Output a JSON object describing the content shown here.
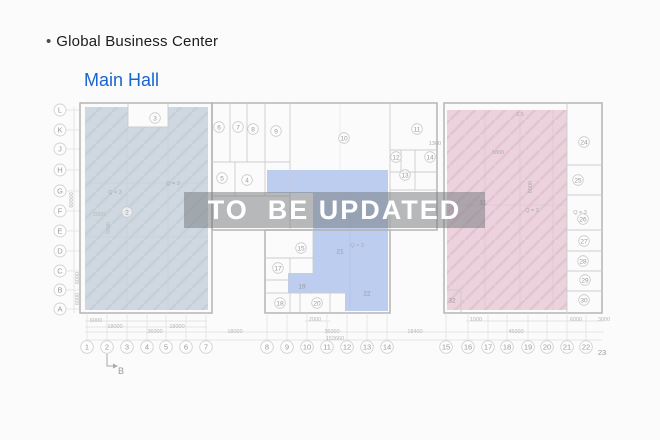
{
  "header": {
    "bullet": "•",
    "title": "Global Business Center",
    "subtitle": "Main Hall"
  },
  "overlay": {
    "text": "TO  BE UPDATED"
  },
  "colors": {
    "accent_blue": "#1a63d2",
    "zone_left": "#cfd8e1",
    "zone_center": "#b6c9ef",
    "zone_right": "#ebd2dc",
    "watermark_text": "#ffffff"
  },
  "plan": {
    "row_labels": [
      "L",
      "K",
      "J",
      "H",
      "G",
      "F",
      "E",
      "D",
      "C",
      "B",
      "A"
    ],
    "col_labels": [
      "1",
      "2",
      "3",
      "4",
      "5",
      "6",
      "7",
      "8",
      "9",
      "10",
      "11",
      "12",
      "13",
      "14",
      "15",
      "16",
      "17",
      "18",
      "19",
      "20",
      "21",
      "22"
    ],
    "col_last": "23",
    "section_marker": "B",
    "room_labels": [
      "2",
      "3",
      "4",
      "5",
      "6",
      "7",
      "8",
      "9",
      "10",
      "11",
      "12",
      "13",
      "14",
      "15",
      "17",
      "18",
      "19",
      "20",
      "21",
      "22",
      "24",
      "25",
      "26",
      "27",
      "28",
      "29",
      "30",
      "31",
      "32"
    ],
    "dim_labels": [
      "6000",
      "2000",
      "1000",
      "6000",
      "3000",
      "18000",
      "18000",
      "36000",
      "18000",
      "36000",
      "18400",
      "45000",
      "153660"
    ],
    "left_dim_labels": [
      "60000",
      "6000",
      "6000",
      "5000",
      "2000"
    ],
    "annotation_labels": [
      "Q = 3",
      "Q = 3",
      "Q = 3",
      "Q = 3",
      "Q = 3",
      "1300",
      "1800",
      "2.5",
      "6000"
    ]
  }
}
